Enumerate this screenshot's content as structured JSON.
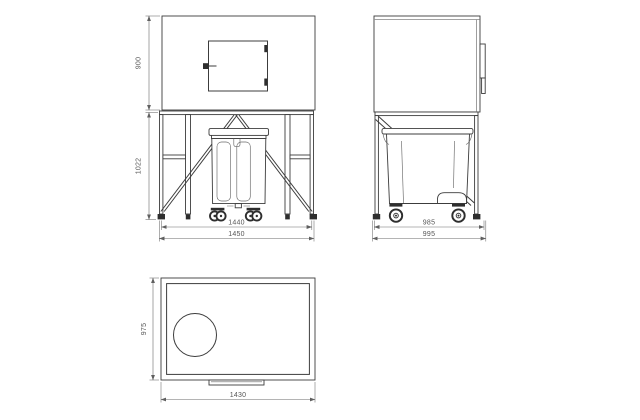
{
  "drawing": {
    "type": "technical-orthographic-drawing",
    "views": {
      "front": {
        "label": "front-view",
        "dims": {
          "hood_height": "900",
          "frame_height": "1022",
          "width_inner": "1440",
          "width_outer": "1450"
        }
      },
      "side": {
        "label": "side-view",
        "dims": {
          "depth_inner": "985",
          "depth_outer": "995"
        }
      },
      "top": {
        "label": "top-view",
        "dims": {
          "depth": "975",
          "width": "1430"
        }
      }
    },
    "colors": {
      "line": "#3c3c3c",
      "dimension": "#6b6b6b",
      "text": "#555555",
      "background": "#ffffff",
      "wheel_dark": "#2e2e2e"
    }
  }
}
